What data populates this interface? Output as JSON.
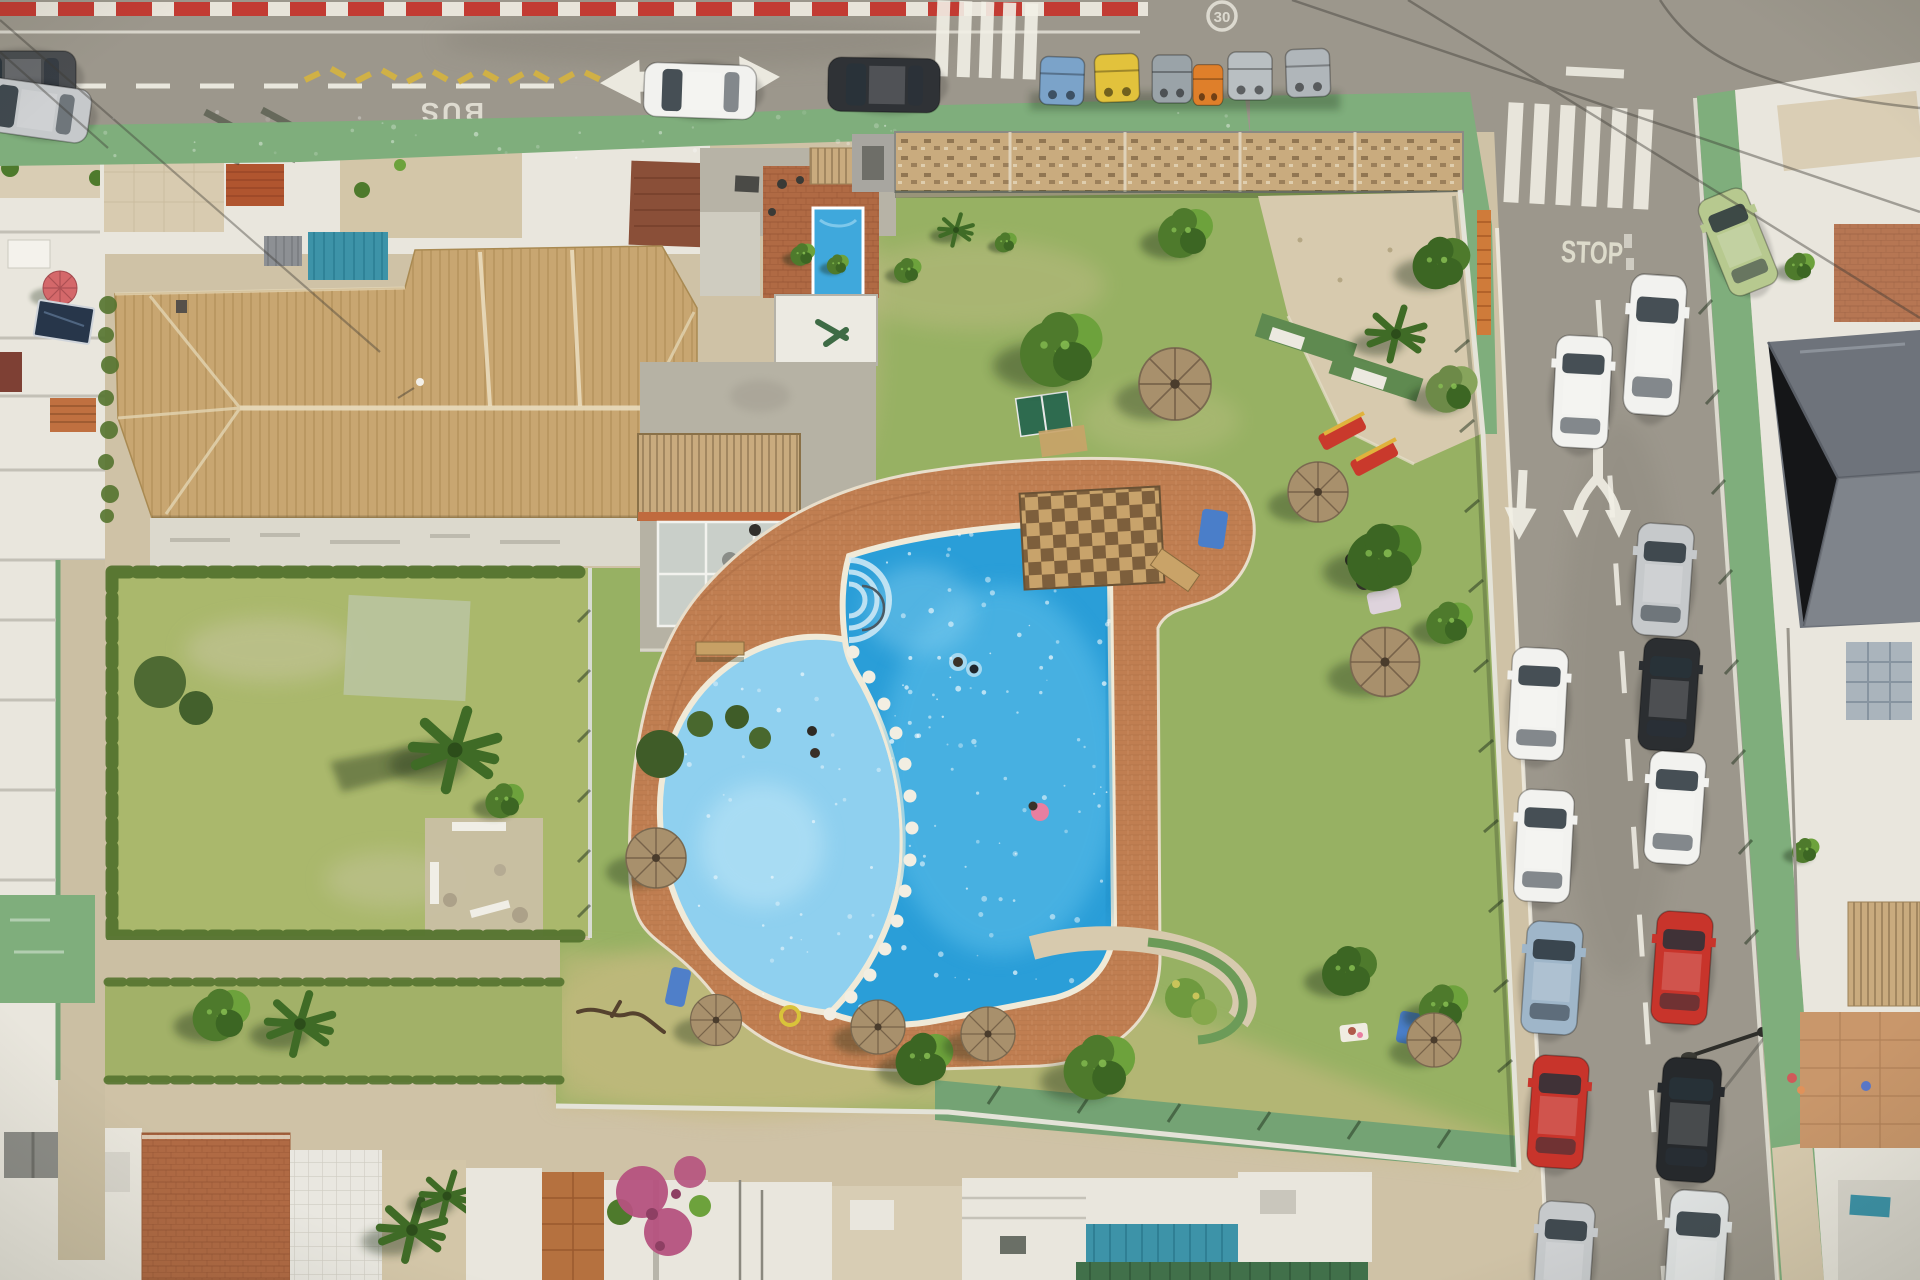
{
  "scene": {
    "type": "aerial-drone-photo",
    "description": "Top-down aerial view of a residential block: communal lawns with a free-form swimming pool, terracotta tiled roofs, hedged private garden, wood pergolas, a top street and a right-hand one-way street with parked cars, zebra crossings and painted road markings."
  },
  "road_markings": {
    "bus_lane": "BUS",
    "stop": "STOP",
    "speed_limit": "30"
  },
  "streets": {
    "top_road": {
      "features": [
        "red-white curb stripe",
        "dashed centre line",
        "double-headed lane arrow",
        "zebra crossing",
        "BUS stencil",
        "30 roundel",
        "yellow zigzag",
        "waste container row"
      ],
      "parked_vehicles": [
        "dark-gray",
        "silver",
        "white",
        "black"
      ],
      "bins": [
        "blue",
        "yellow",
        "gray",
        "orange",
        "gray",
        "gray"
      ]
    },
    "right_road": {
      "direction": "one-way downward",
      "features": [
        "zebra crossing",
        "stop line",
        "STOP stencil",
        "single down arrow",
        "split down arrow",
        "dashed centre line",
        "streetlamp"
      ],
      "parked_left_column": [
        "white",
        "white",
        "blue-gray",
        "red",
        "silver"
      ],
      "parked_middle": [
        "white"
      ],
      "parked_right_column": [
        "white",
        "silver",
        "black",
        "white",
        "red",
        "black-suv",
        "white-van"
      ],
      "corner_vehicle": "light-green"
    }
  },
  "community": {
    "pool": {
      "shape": "free-form with round shallow lobe",
      "stepping_stones": 14,
      "roman_steps": true,
      "swimmers": 5,
      "float_color": "pink"
    },
    "furniture": {
      "straw_parasols": 8,
      "red_yellow_loungers": 2,
      "benches": 2,
      "table_tennis_table": 1,
      "pool_pergola": 1
    },
    "landscape": [
      "main lawn",
      "dry south lawn",
      "hedged private garden with palm",
      "gravel corner with topiary",
      "wood pergola fence line",
      "brick pool deck",
      "curved flower planter"
    ]
  },
  "palette": {
    "asphalt": "#9c978c",
    "asphalt_dark": "#8a857a",
    "curb_red": "#c23b33",
    "marking_white": "#f2f0e6",
    "lane_yellow": "#d9b53a",
    "sidewalk_green": "#7fae7c",
    "walkway_green": "#74a374",
    "lawn": "#97b163",
    "lawn_pale": "#aab86c",
    "lawn_dry": "#c6ba80",
    "hedge": "#55742f",
    "tree": "#4e7a2c",
    "tree_light": "#6da23c",
    "tree_dark": "#3c6623",
    "palm": "#3f6b26",
    "roof_tan": "#c8a671",
    "roof_line": "#ae8c55",
    "deck_brick": "#c07e51",
    "terracotta": "#b06a44",
    "pool_main": "#2a9ed8",
    "pool_shallow": "#8fd0ef",
    "coping": "#f0ead8",
    "concrete": "#b6b2a4",
    "paver_beige": "#d7caae",
    "pavement": "#cfc2a6",
    "building_white": "#e9e6dd",
    "wall_gray": "#8a8a84",
    "pergola_wood": "#c9ab7e",
    "teal_roof": "#3d93a8",
    "green_roof": "#41704a",
    "redbrown_roof": "#8a4f38",
    "graytile_roof": "#6e737b",
    "bougainvillea": "#b5527e",
    "umbrella_straw": "#a8906c",
    "umbrella_line": "#6d5942",
    "pink_umbrella": "#d4686a",
    "solar_panel": "#27364a",
    "lounger_red": "#c9392c",
    "towel_blue": "#4a7ec9",
    "float_pink": "#e87fa0",
    "car_white": "#f2f2ef",
    "car_silver": "#c6c9cb",
    "car_black": "#2b2e31",
    "car_red": "#c8342b",
    "car_blue": "#9fb6c9",
    "car_green": "#b7c98f",
    "bin_blue": "#7ba3c9",
    "bin_yellow": "#e2c23c",
    "bin_orange": "#df7f2a",
    "bin_gray": "#9aa3a8",
    "shadow_green": "#1e2e14"
  }
}
